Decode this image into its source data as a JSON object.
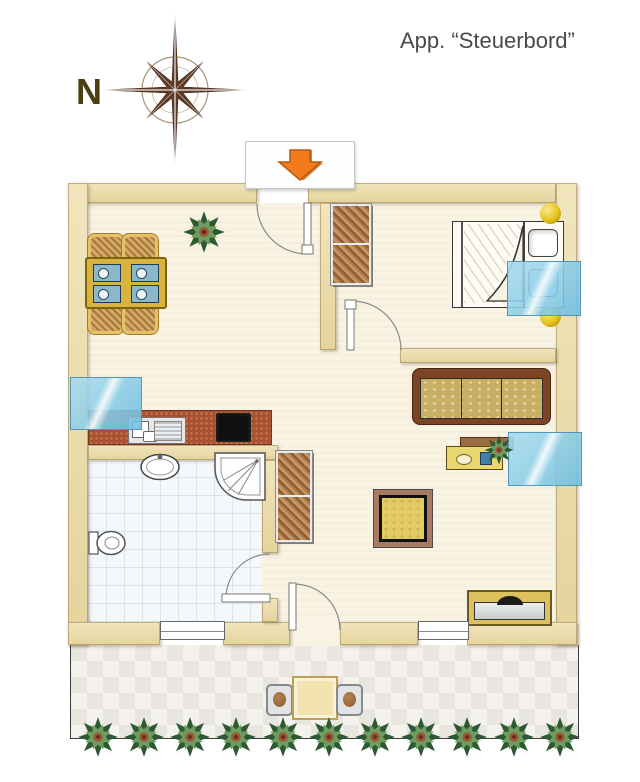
{
  "title": "App. “Steuerbord”",
  "compass": {
    "north_label": "N",
    "icon": "compass-rose-icon"
  },
  "entrance": {
    "icon": "arrow-down-icon"
  },
  "colors": {
    "wall_beige": "#e9dcae",
    "floor_cream": "#f9f3e3",
    "bathroom_tile": "#f5f8fa",
    "terrace_tile": "#efede9",
    "window_blue": "#8cc8e4",
    "kitchen_counter": "#a9502c",
    "arrow_orange": "#f47a1e",
    "compass_brown": "#5d3a28",
    "title_color": "#4a4a4a"
  },
  "furniture": [
    "dining-table",
    "dining-chairs",
    "indoor-plant",
    "kitchen-counter",
    "kitchen-sink",
    "stove",
    "bedroom-wardrobe",
    "double-bed",
    "bedside-lamps",
    "sofa",
    "sideboard",
    "coffee-table",
    "hall-cabinet",
    "tv-bench",
    "washbasin",
    "shower",
    "toilet",
    "terrace-table",
    "terrace-chairs",
    "terrace-plants"
  ]
}
